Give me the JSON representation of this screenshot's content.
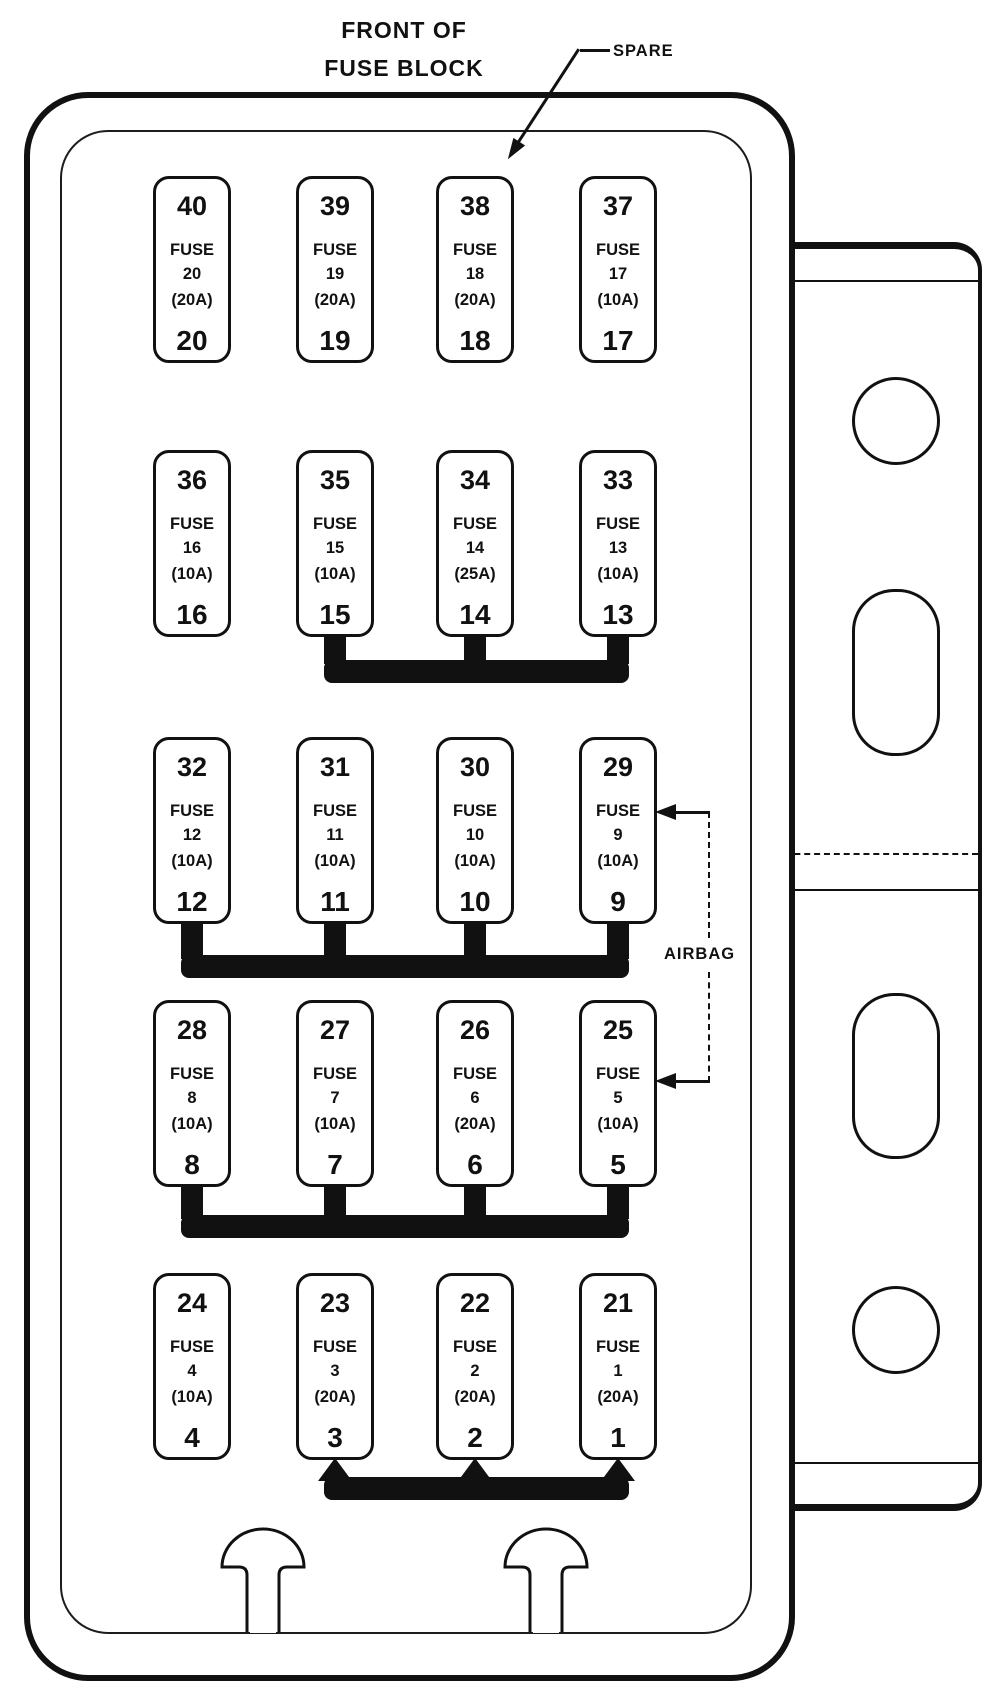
{
  "title": {
    "line1": "FRONT OF",
    "line2": "FUSE BLOCK"
  },
  "callouts": {
    "spare": {
      "label": "SPARE",
      "points_to": "cavity 38"
    },
    "airbag": {
      "label": "AIRBAG",
      "points_to": [
        "cavity 29 (fuse 9)",
        "cavity 25 (fuse 5)"
      ]
    }
  },
  "fuses": [
    {
      "cavity": "40",
      "label": "FUSE",
      "circuit": "20",
      "amp": "(20A)",
      "fuse": "20",
      "col": 0,
      "row": 0
    },
    {
      "cavity": "39",
      "label": "FUSE",
      "circuit": "19",
      "amp": "(20A)",
      "fuse": "19",
      "col": 1,
      "row": 0
    },
    {
      "cavity": "38",
      "label": "FUSE",
      "circuit": "18",
      "amp": "(20A)",
      "fuse": "18",
      "col": 2,
      "row": 0
    },
    {
      "cavity": "37",
      "label": "FUSE",
      "circuit": "17",
      "amp": "(10A)",
      "fuse": "17",
      "col": 3,
      "row": 0
    },
    {
      "cavity": "36",
      "label": "FUSE",
      "circuit": "16",
      "amp": "(10A)",
      "fuse": "16",
      "col": 0,
      "row": 1
    },
    {
      "cavity": "35",
      "label": "FUSE",
      "circuit": "15",
      "amp": "(10A)",
      "fuse": "15",
      "col": 1,
      "row": 1
    },
    {
      "cavity": "34",
      "label": "FUSE",
      "circuit": "14",
      "amp": "(25A)",
      "fuse": "14",
      "col": 2,
      "row": 1
    },
    {
      "cavity": "33",
      "label": "FUSE",
      "circuit": "13",
      "amp": "(10A)",
      "fuse": "13",
      "col": 3,
      "row": 1
    },
    {
      "cavity": "32",
      "label": "FUSE",
      "circuit": "12",
      "amp": "(10A)",
      "fuse": "12",
      "col": 0,
      "row": 2
    },
    {
      "cavity": "31",
      "label": "FUSE",
      "circuit": "11",
      "amp": "(10A)",
      "fuse": "11",
      "col": 1,
      "row": 2
    },
    {
      "cavity": "30",
      "label": "FUSE",
      "circuit": "10",
      "amp": "(10A)",
      "fuse": "10",
      "col": 2,
      "row": 2
    },
    {
      "cavity": "29",
      "label": "FUSE",
      "circuit": "9",
      "amp": "(10A)",
      "fuse": "9",
      "col": 3,
      "row": 2
    },
    {
      "cavity": "28",
      "label": "FUSE",
      "circuit": "8",
      "amp": "(10A)",
      "fuse": "8",
      "col": 0,
      "row": 3
    },
    {
      "cavity": "27",
      "label": "FUSE",
      "circuit": "7",
      "amp": "(10A)",
      "fuse": "7",
      "col": 1,
      "row": 3
    },
    {
      "cavity": "26",
      "label": "FUSE",
      "circuit": "6",
      "amp": "(20A)",
      "fuse": "6",
      "col": 2,
      "row": 3
    },
    {
      "cavity": "25",
      "label": "FUSE",
      "circuit": "5",
      "amp": "(10A)",
      "fuse": "5",
      "col": 3,
      "row": 3
    },
    {
      "cavity": "24",
      "label": "FUSE",
      "circuit": "4",
      "amp": "(10A)",
      "fuse": "4",
      "col": 0,
      "row": 4
    },
    {
      "cavity": "23",
      "label": "FUSE",
      "circuit": "3",
      "amp": "(20A)",
      "fuse": "3",
      "col": 1,
      "row": 4
    },
    {
      "cavity": "22",
      "label": "FUSE",
      "circuit": "2",
      "amp": "(20A)",
      "fuse": "2",
      "col": 2,
      "row": 4
    },
    {
      "cavity": "21",
      "label": "FUSE",
      "circuit": "1",
      "amp": "(20A)",
      "fuse": "1",
      "col": 3,
      "row": 4
    }
  ],
  "bus_bars": [
    {
      "after_row": 1,
      "cols": [
        1,
        2,
        3
      ],
      "tapered": false,
      "joins_fuses": [
        "15",
        "14",
        "13"
      ]
    },
    {
      "after_row": 2,
      "cols": [
        0,
        1,
        2,
        3
      ],
      "tapered": false,
      "joins_fuses": [
        "12",
        "11",
        "10",
        "9"
      ]
    },
    {
      "after_row": 3,
      "cols": [
        0,
        1,
        2,
        3
      ],
      "tapered": false,
      "joins_fuses": [
        "8",
        "7",
        "6",
        "5"
      ]
    },
    {
      "after_row": 4,
      "cols": [
        1,
        2,
        3
      ],
      "tapered": true,
      "joins_fuses": [
        "3",
        "2",
        "1"
      ]
    }
  ],
  "colors": {
    "ink": "#111111",
    "background": "#ffffff"
  }
}
